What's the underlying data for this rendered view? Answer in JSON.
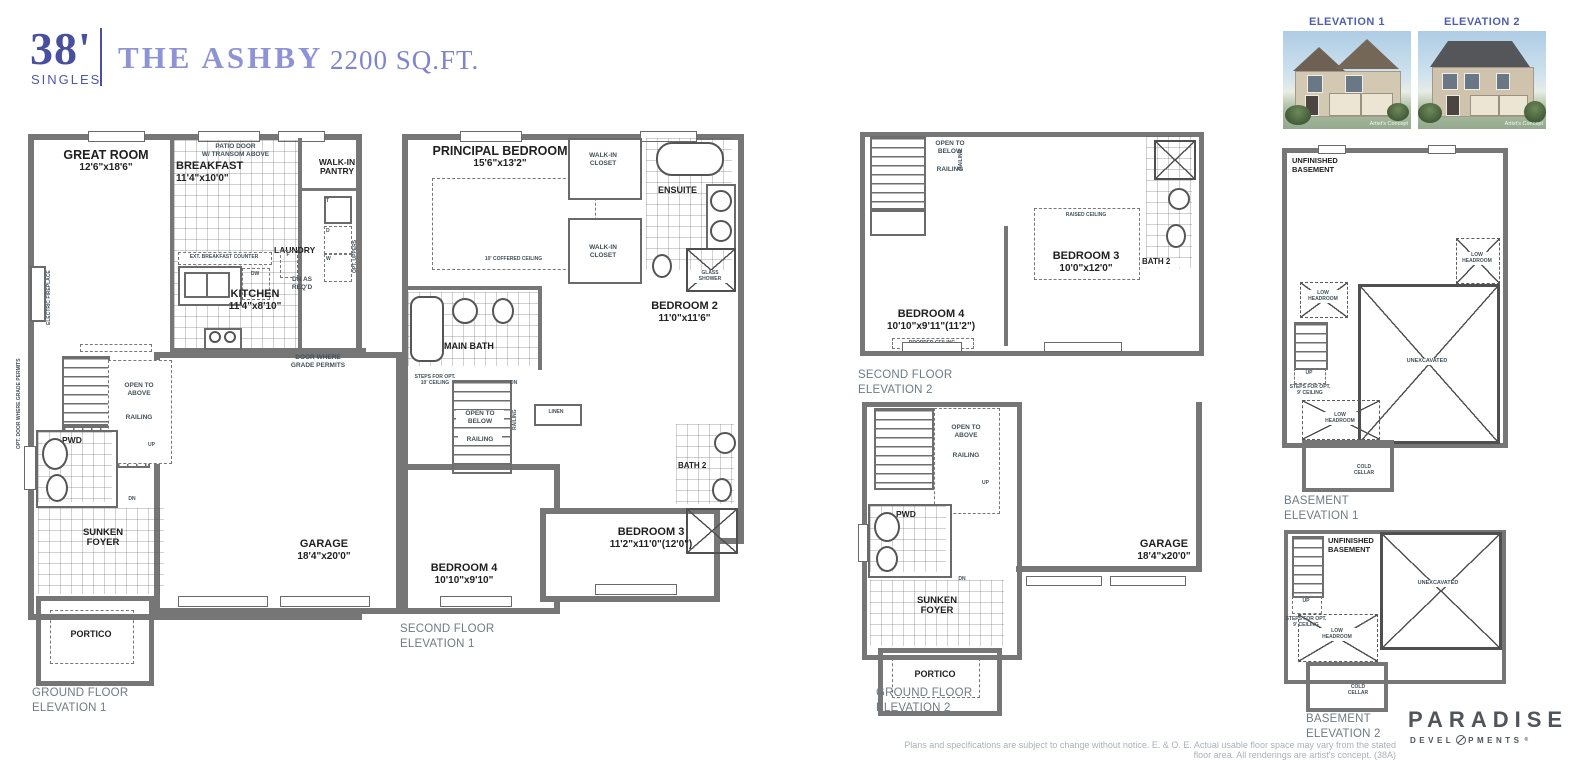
{
  "header": {
    "frontage": "38'",
    "product": "SINGLES",
    "model": "THE ASHBY",
    "sqft": "2200 SQ.FT."
  },
  "photos": {
    "p1": {
      "label": "ELEVATION 1",
      "credit": "Artist's Concept"
    },
    "p2": {
      "label": "ELEVATION 2",
      "credit": "Artist's Concept"
    }
  },
  "plan_gf1": {
    "great_room": "GREAT ROOM",
    "great_room_dim": "12'6\"x18'6\"",
    "breakfast": "BREAKFAST",
    "breakfast_dim": "11'4\"x10'0\"",
    "patio1": "PATIO DOOR",
    "patio2": "W/ TRANSOM ABOVE",
    "pantry1": "WALK-IN",
    "pantry2": "PANTRY",
    "laundry": "LAUNDRY",
    "t": "T",
    "d": "D",
    "w": "W",
    "opt_uppers": "OPT. UPPERS",
    "ext_counter": "EXT. BREAKFAST COUNTER",
    "dw": "DW",
    "f": "F",
    "kitchen": "KITCHEN",
    "kitchen_dim": "11'4\"x8'10\"",
    "fireplace": "ELECTRIC FIREPLACE",
    "dn_req1": "DN AS",
    "dn_req2": "REQ'D",
    "door_grade1": "DOOR WHERE",
    "door_grade2": "GRADE PERMITS",
    "opt_door_grade": "OPT. DOOR WHERE GRADE PERMITS",
    "dn": "DN",
    "dn2": "DN",
    "up": "UP",
    "open1": "OPEN TO",
    "open2": "ABOVE",
    "railing": "RAILING",
    "pwd": "PWD",
    "foyer1": "SUNKEN",
    "foyer2": "FOYER",
    "garage": "GARAGE",
    "garage_dim": "18'4\"x20'0\"",
    "portico": "PORTICO",
    "cap1": "GROUND FLOOR",
    "cap2": "ELEVATION 1"
  },
  "plan_sf1": {
    "principal": "PRINCIPAL BEDROOM",
    "principal_dim": "15'6\"x13'2\"",
    "coffered": "10' COFFERED CEILING",
    "wic1a": "WALK-IN",
    "wic1b": "CLOSET",
    "wic2a": "WALK-IN",
    "wic2b": "CLOSET",
    "ensuite": "ENSUITE",
    "glass1": "GLASS",
    "glass2": "SHOWER",
    "bedroom2": "BEDROOM 2",
    "bedroom2_dim": "11'0\"x11'6\"",
    "main_bath": "MAIN BATH",
    "steps1": "STEPS FOR OPT.",
    "steps2": "10' CEILING",
    "dn": "DN",
    "open1": "OPEN TO",
    "open2": "BELOW",
    "railing": "RAILING",
    "railing_v": "RAILING",
    "linen": "LINEN",
    "bath2": "BATH 2",
    "bedroom3": "BEDROOM 3",
    "bedroom3_dim": "11'2\"x11'0\"(12'0\")",
    "bedroom4": "BEDROOM 4",
    "bedroom4_dim": "10'10\"x9'10\"",
    "cap1": "SECOND FLOOR",
    "cap2": "ELEVATION 1"
  },
  "plan_sf2": {
    "open1": "OPEN TO",
    "open2": "BELOW",
    "railing": "RAILING",
    "railing_v": "RAILING",
    "raised": "RAISED CEILING",
    "bedroom3": "BEDROOM 3",
    "bedroom3_dim": "10'0\"x12'0\"",
    "bath2": "BATH 2",
    "bedroom4": "BEDROOM 4",
    "bedroom4_dim": "10'10\"x9'11\"(11'2\")",
    "dropped": "DROPPED CEILING",
    "cap1": "SECOND FLOOR",
    "cap2": "ELEVATION 2"
  },
  "plan_gf2": {
    "open1": "OPEN TO",
    "open2": "ABOVE",
    "railing": "RAILING",
    "up": "UP",
    "pwd": "PWD",
    "dn": "DN",
    "foyer1": "SUNKEN",
    "foyer2": "FOYER",
    "garage": "GARAGE",
    "garage_dim": "18'4\"x20'0\"",
    "portico": "PORTICO",
    "cap1": "GROUND FLOOR",
    "cap2": "ELEVATION 2"
  },
  "plan_b1": {
    "unf1": "UNFINISHED",
    "unf2": "BASEMENT",
    "lh1a": "LOW",
    "lh1b": "HEADROOM",
    "lh2a": "LOW",
    "lh2b": "HEADROOM",
    "lh3a": "LOW",
    "lh3b": "HEADROOM",
    "unex": "UNEXCAVATED",
    "up": "UP",
    "steps1": "STEPS FOR OPT.",
    "steps2": "9' CEILING",
    "cold1": "COLD",
    "cold2": "CELLAR",
    "cap1": "BASEMENT",
    "cap2": "ELEVATION 1"
  },
  "plan_b2": {
    "unf1": "UNFINISHED",
    "unf2": "BASEMENT",
    "unex": "UNEXCAVATED",
    "up": "UP",
    "steps1": "STEPS FOR OPT.",
    "steps2": "9' CEILING",
    "lh1a": "LOW",
    "lh1b": "HEADROOM",
    "cold1": "COLD",
    "cold2": "CELLAR",
    "cap1": "BASEMENT",
    "cap2": "ELEVATION 2"
  },
  "footer": {
    "disclaimer": "Plans and specifications are subject to change without notice. E. & O. E.  Actual usable floor space may vary from the stated floor area. All renderings are artist's concept. (38A)",
    "brand": "PARADISE",
    "brand_sub_left": "DEVEL",
    "brand_sub_right": "PMENTS",
    "reg": "®"
  }
}
